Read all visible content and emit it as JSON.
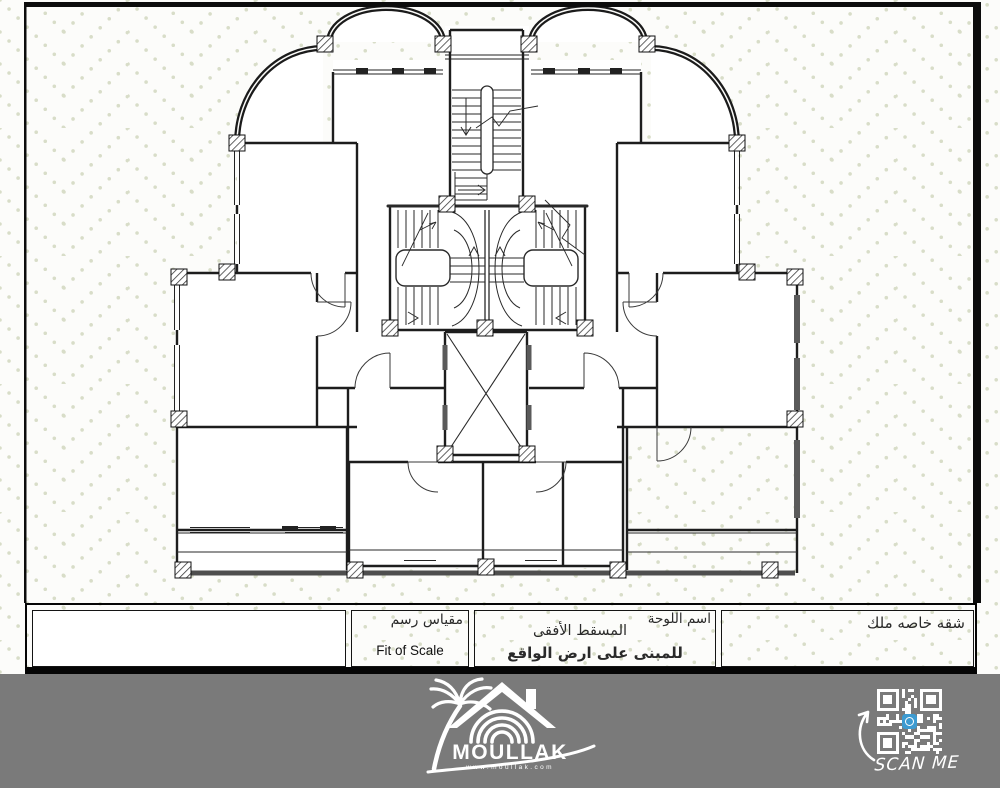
{
  "drawing": {
    "type": "architectural-floor-plan",
    "content": "horizontal projection floor plan of a residential building with twin curved stairs, elevator shaft, two top arched balconies and symmetric apartment wings"
  },
  "title_block": {
    "notes_cell": "",
    "scale_cell": {
      "label_ar": "مقياس رسم",
      "value": "Fit of Scale"
    },
    "sheet_cell": {
      "label_ar": "اسم اللوحة",
      "title_ar": "المسقط الأفقى",
      "subtitle_ar": "للمبنى على ارض الواقع"
    },
    "project_cell": {
      "title_ar": "شقه خاصه ملك"
    }
  },
  "footer": {
    "brand": "MOULLAK",
    "website": "www.moullak.com",
    "qr_caption": "SCAN ME"
  },
  "colors": {
    "footer_bg": "#7a7a7a",
    "pattern_dot": "#d8ddc8",
    "frame": "#0c0c0c",
    "wall": "#1d1d1d",
    "qr_icon_blue": "#3d9bd1",
    "heavy_edge": "#4e4e4e"
  }
}
